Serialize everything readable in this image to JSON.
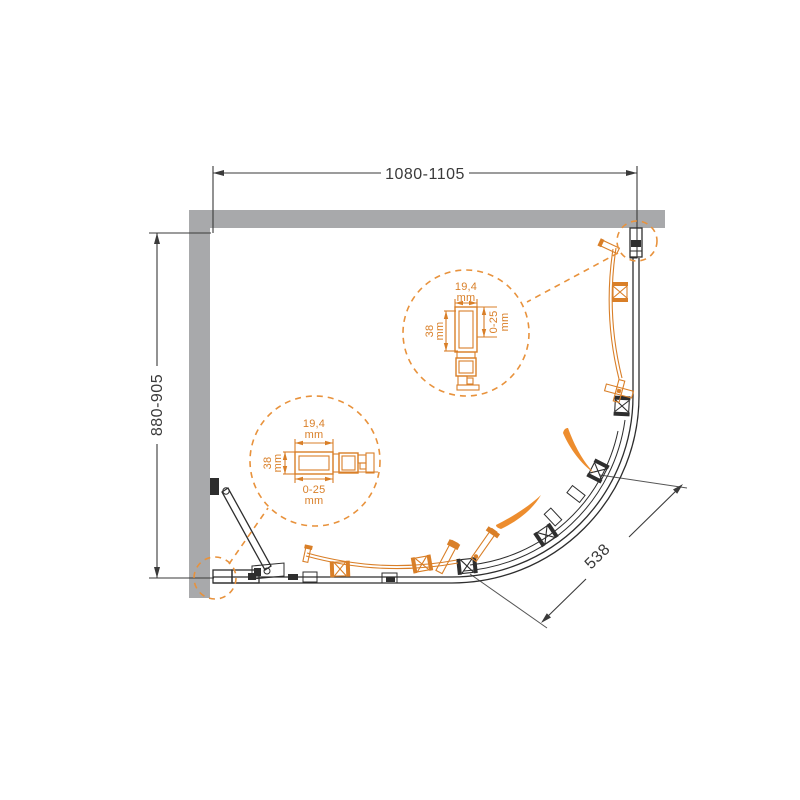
{
  "drawing": {
    "title": "quadrant-shower-enclosure-plan",
    "dim_width_label": "1080-1105",
    "dim_depth_label": "880-905",
    "dim_opening_label": "538"
  },
  "detail_right": {
    "width_value": "19,4",
    "width_unit": "mm",
    "height_value": "38",
    "height_unit": "mm",
    "range_value": "0-25",
    "range_unit": "mm"
  },
  "detail_bottom": {
    "width_value": "19,4",
    "width_unit": "mm",
    "height_value": "38",
    "height_unit": "mm",
    "range_value": "0-25",
    "range_unit": "mm"
  },
  "colors": {
    "accent_orange": "#d97f28",
    "arrow_orange": "#ed8d2e",
    "wall_gray": "#a8a9ab",
    "line_black": "#2e2e2e"
  }
}
